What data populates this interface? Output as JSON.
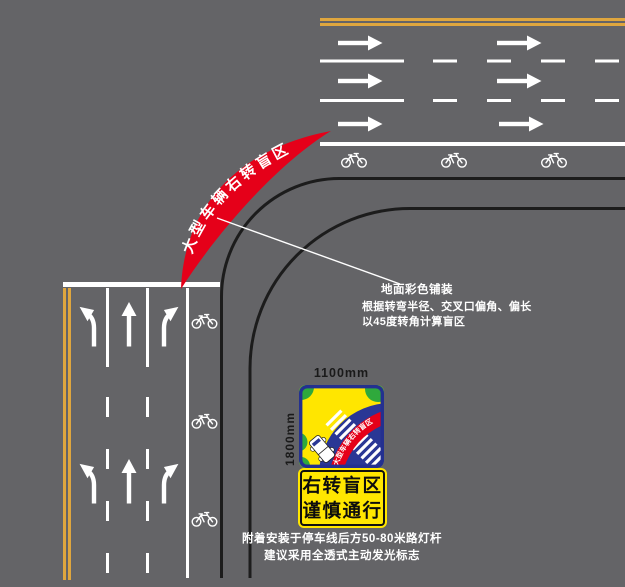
{
  "diagram_title": "右转盲区交叉口示意图",
  "colors": {
    "background": "#646467",
    "lane_marking_white": "#ffffff",
    "center_line_yellow": "#DFA63E",
    "curb_black": "#1c1c1c",
    "blind_zone_red": "#E50019",
    "sign_blue": "#2A3795",
    "sign_yellow": "#FFE600",
    "sign_green": "#2FA93C"
  },
  "blind_zone": {
    "label_text": "大型车辆右转盲区"
  },
  "annotations": {
    "pavement": "地面彩色铺装",
    "calc_line1": "根据转弯半径、交叉口偏角、偏长",
    "calc_line2": "以45度转角计算盲区"
  },
  "sign": {
    "width_label": "1100mm",
    "height_label": "1800mm",
    "pictogram_band_text": "大型车辆右转盲区",
    "plaque_line1": "右转盲区",
    "plaque_line2": "谨慎通行"
  },
  "notes": {
    "line1": "附着安装于停车线后方50-80米路灯杆",
    "line2": "建议采用全透式主动发光标志"
  },
  "icons": {
    "bicycle": "bicycle-icon",
    "straight_arrow": "straight-arrow-icon",
    "left_turn_arrow": "left-turn-arrow-icon",
    "right_turn_arrow": "right-turn-arrow-icon",
    "truck": "truck-icon"
  }
}
